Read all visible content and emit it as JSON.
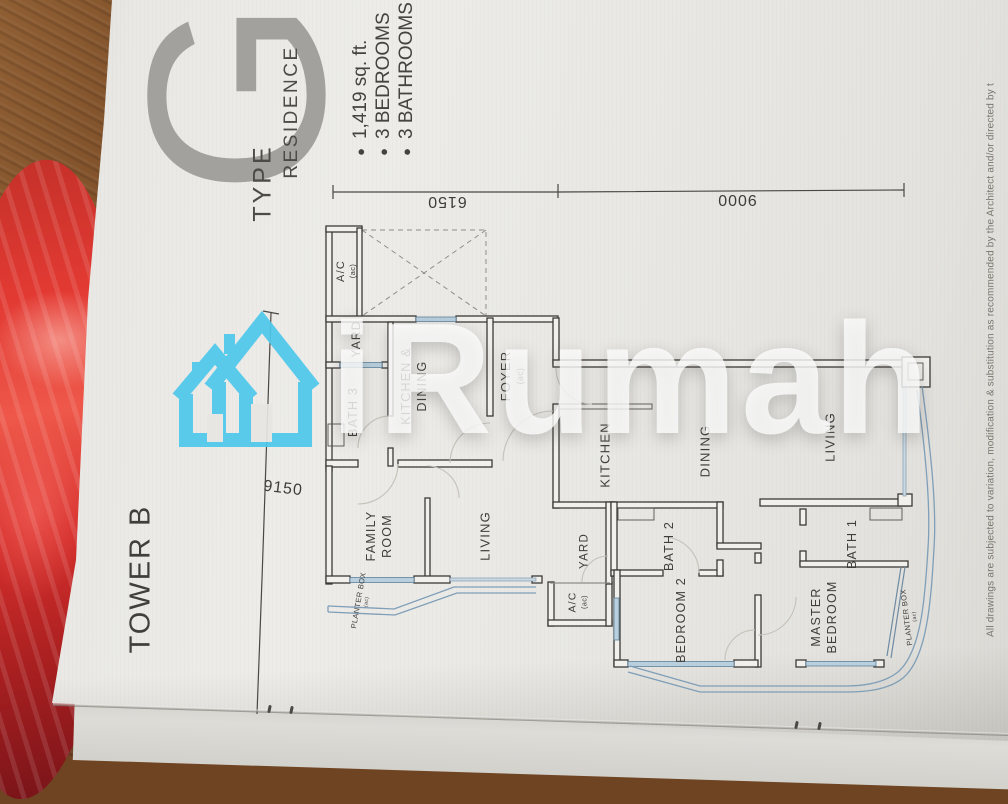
{
  "header": {
    "tower": "TOWER B",
    "type_label": "TYPE",
    "type_letter": "G",
    "residence_label": "RESIDENCE",
    "specs": [
      {
        "text": "1,419 sq. ft."
      },
      {
        "text": "3 BEDROOMS"
      },
      {
        "text": "3 BATHROOMS"
      }
    ]
  },
  "dimensions": {
    "width_upper": "6150",
    "width_lower": "9000",
    "depth": "9150"
  },
  "plan": {
    "rooms": [
      {
        "label": "A/C",
        "sub": "(ac)"
      },
      {
        "label": "YARD"
      },
      {
        "label": "BATH 3"
      },
      {
        "label": "KITCHEN &",
        "label2": "DINING"
      },
      {
        "label": "FOYER",
        "sub": "(ac)"
      },
      {
        "label": "KITCHEN"
      },
      {
        "label": "DINING"
      },
      {
        "label": "LIVING"
      },
      {
        "label": "FAMILY",
        "label2": "ROOM"
      },
      {
        "label": "YARD"
      },
      {
        "label": "A/C",
        "sub": "(ac)"
      },
      {
        "label": "BATH 2"
      },
      {
        "label": "BEDROOM 2"
      },
      {
        "label": "MASTER",
        "label2": "BEDROOM"
      },
      {
        "label": "BATH 1"
      },
      {
        "label": "LIVING"
      },
      {
        "label": "PLANTER BOX",
        "sub": "(ac)"
      },
      {
        "label": "PLANTER BOX",
        "sub": "(ac)"
      }
    ]
  },
  "watermark": {
    "brand": "iRumah"
  },
  "footer": {
    "disclaimer": "All drawings are subjected to variation, modification & substitution as recommended by the Architect and/or directed by t"
  }
}
